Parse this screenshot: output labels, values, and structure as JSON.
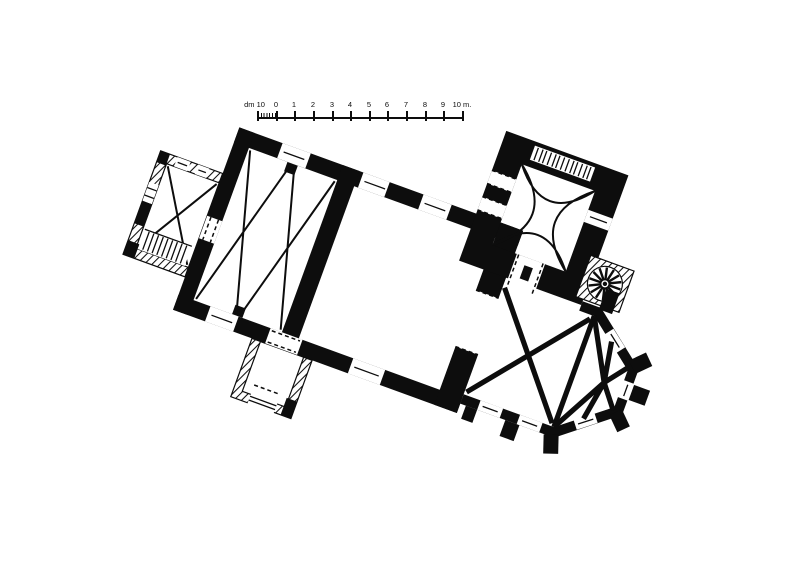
{
  "colors": {
    "ink": "#0d0d0d",
    "paper": "#ffffff"
  },
  "figure": {
    "kind": "measured floor plan of a church, drawn rotated on the sheet",
    "rotation_deg": 20
  },
  "scale_bar": {
    "labels": [
      "dm 10",
      "0",
      "1",
      "2",
      "3",
      "4",
      "5",
      "6",
      "7",
      "8",
      "9",
      "10 m."
    ],
    "tick_count": 12,
    "subdivided_left_interval": "decimeters"
  },
  "plan": {
    "parts": [
      {
        "name": "west-annex",
        "wall_style": "hatched",
        "features": [
          "cross-vault-diagonals",
          "corner-staircase",
          "wall-windows"
        ]
      },
      {
        "name": "nave-western-bays",
        "wall_style": "solid",
        "features": [
          "two-vault-bays-zigzag-diagonals",
          "wall-pilasters"
        ]
      },
      {
        "name": "nave-hall",
        "wall_style": "solid",
        "features": [
          "window-slots"
        ]
      },
      {
        "name": "south-porch",
        "wall_style": "hatched",
        "features": [
          "entrance-opening",
          "door-to-nave"
        ]
      },
      {
        "name": "chancel-arch",
        "wall_style": "solid",
        "features": [
          "pier-pair",
          "dashed-arch-lines"
        ]
      },
      {
        "name": "north-tower",
        "wall_style": "solid",
        "features": [
          "cloister-vault-arcs",
          "intramural-stair",
          "dashed-openings"
        ]
      },
      {
        "name": "spiral-stair",
        "wall_style": "hatched",
        "features": [
          "radial-treads"
        ]
      },
      {
        "name": "choir-bay",
        "wall_style": "solid",
        "features": [
          "cross-rib-vault",
          "buttresses",
          "windows"
        ]
      },
      {
        "name": "polygonal-apse",
        "wall_style": "solid",
        "features": [
          "radiating-ribs",
          "diagonal-buttresses",
          "windows"
        ]
      }
    ]
  }
}
